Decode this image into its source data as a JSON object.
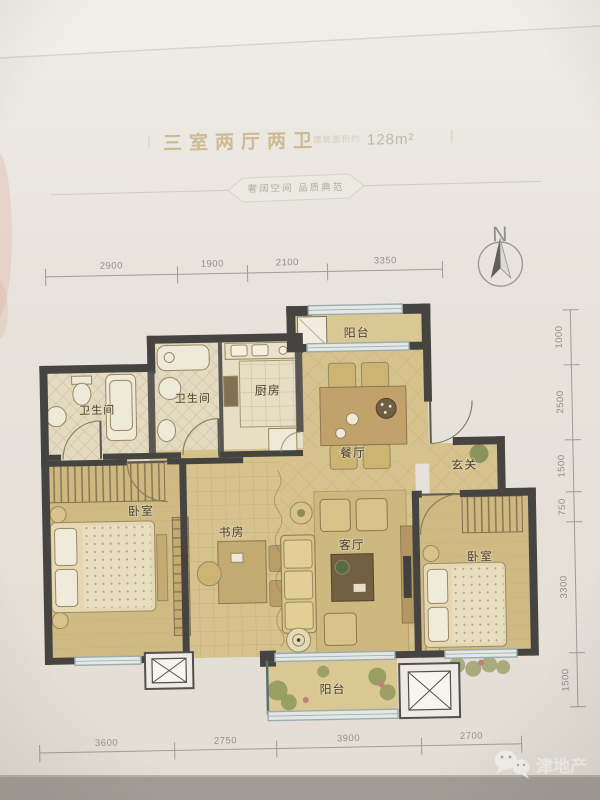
{
  "header": {
    "bar_left": "|",
    "title": "三室两厅两卫",
    "area_note": "建筑面积约",
    "area_value": "128m²",
    "bar_right": "|",
    "tagline": "奢阔空间 品质典范"
  },
  "compass": {
    "label": "N"
  },
  "rooms": {
    "balcony_top": "阳台",
    "bath_left": "卫生间",
    "bath_mid": "卫生间",
    "kitchen": "厨房",
    "dining": "餐厅",
    "foyer": "玄关",
    "bedroom_left": "卧室",
    "study": "书房",
    "living": "客厅",
    "bedroom_right": "卧室",
    "balcony_bottom": "阳台"
  },
  "dimensions": {
    "top": [
      "2900",
      "1900",
      "2100",
      "3350"
    ],
    "bottom": [
      "3600",
      "2750",
      "3900",
      "2700"
    ],
    "right": [
      "1000",
      "2500",
      "1500",
      "750",
      "3300",
      "1500"
    ]
  },
  "watermark": {
    "brand": "津地产",
    "icon": "wechat-icon"
  },
  "colors": {
    "floor": "#d6c28b",
    "bedroom_floor": "#cfba82",
    "balcony_floor": "#dbc992",
    "bath_floor": "#e4dcc2",
    "wall": "#3f3e3c",
    "window_frame": "#97abb2",
    "title_gold": "#c9b285",
    "dim_text": "#8f8d89",
    "background": "#e9e5df",
    "footer_band": "#a09c96",
    "watermark_text": "#f7f5f1"
  }
}
